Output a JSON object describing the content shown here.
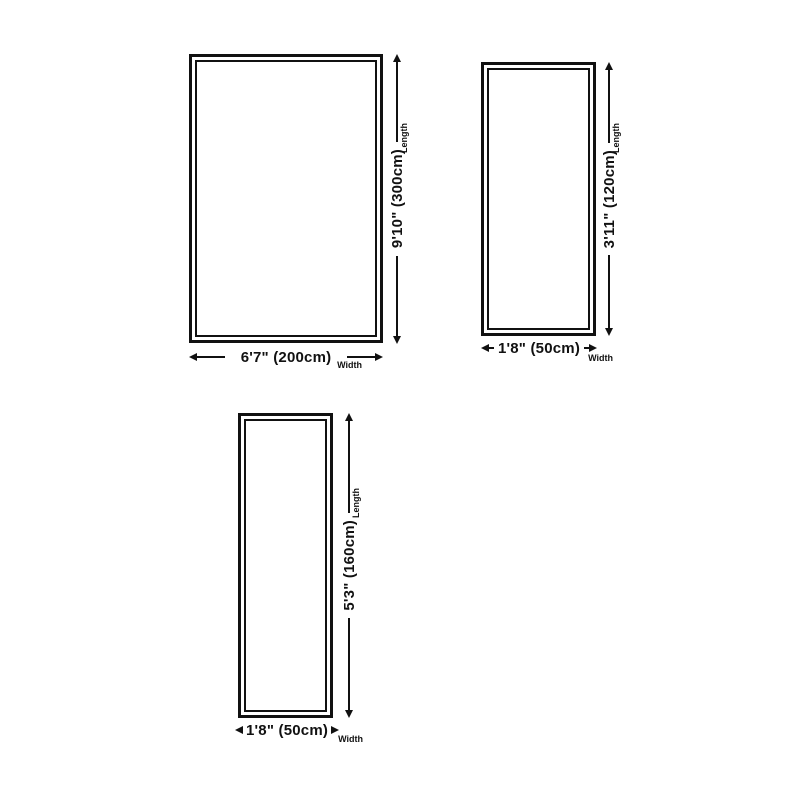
{
  "page": {
    "background_color": "#ffffff",
    "line_color": "#111111"
  },
  "labels": {
    "length": "Length",
    "width": "Width"
  },
  "rugs": [
    {
      "name": "rug-size-200x300",
      "width_label": "6'7\" (200cm)",
      "length_label": "9'10\" (300cm)",
      "width_cm": 200,
      "length_cm": 300
    },
    {
      "name": "rug-size-50x120",
      "width_label": "1'8\" (50cm)",
      "length_label": "3'11\" (120cm)",
      "width_cm": 50,
      "length_cm": 120
    },
    {
      "name": "rug-size-50x160",
      "width_label": "1'8\" (50cm)",
      "length_label": "5'3\" (160cm)",
      "width_cm": 50,
      "length_cm": 160
    }
  ]
}
